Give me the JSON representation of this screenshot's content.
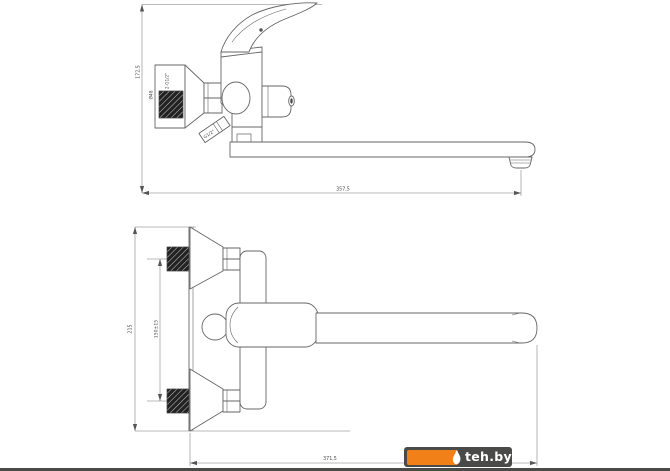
{
  "canvas": {
    "width": 670,
    "height": 471,
    "background": "#ffffff",
    "line_color": "#666666",
    "dimension_line_color": "#777777",
    "text_color": "#4a4a4a"
  },
  "side_view": {
    "title": "side view of wall-mounted bath mixer with long spout",
    "labels": {
      "height": "172,5",
      "escutcheon": "Ø48",
      "connections": "2-G1/2\"",
      "shower_thread": "G1/2\"",
      "reach": "357,5"
    }
  },
  "top_view": {
    "title": "plan view of wall-mounted bath mixer",
    "labels": {
      "span": "215",
      "centers": "150±15",
      "length": "371,5"
    }
  },
  "watermark": {
    "text": "teh.by",
    "accent_color": "#f28018",
    "bar_color": "#4a4a48",
    "icon": "flame-icon"
  }
}
